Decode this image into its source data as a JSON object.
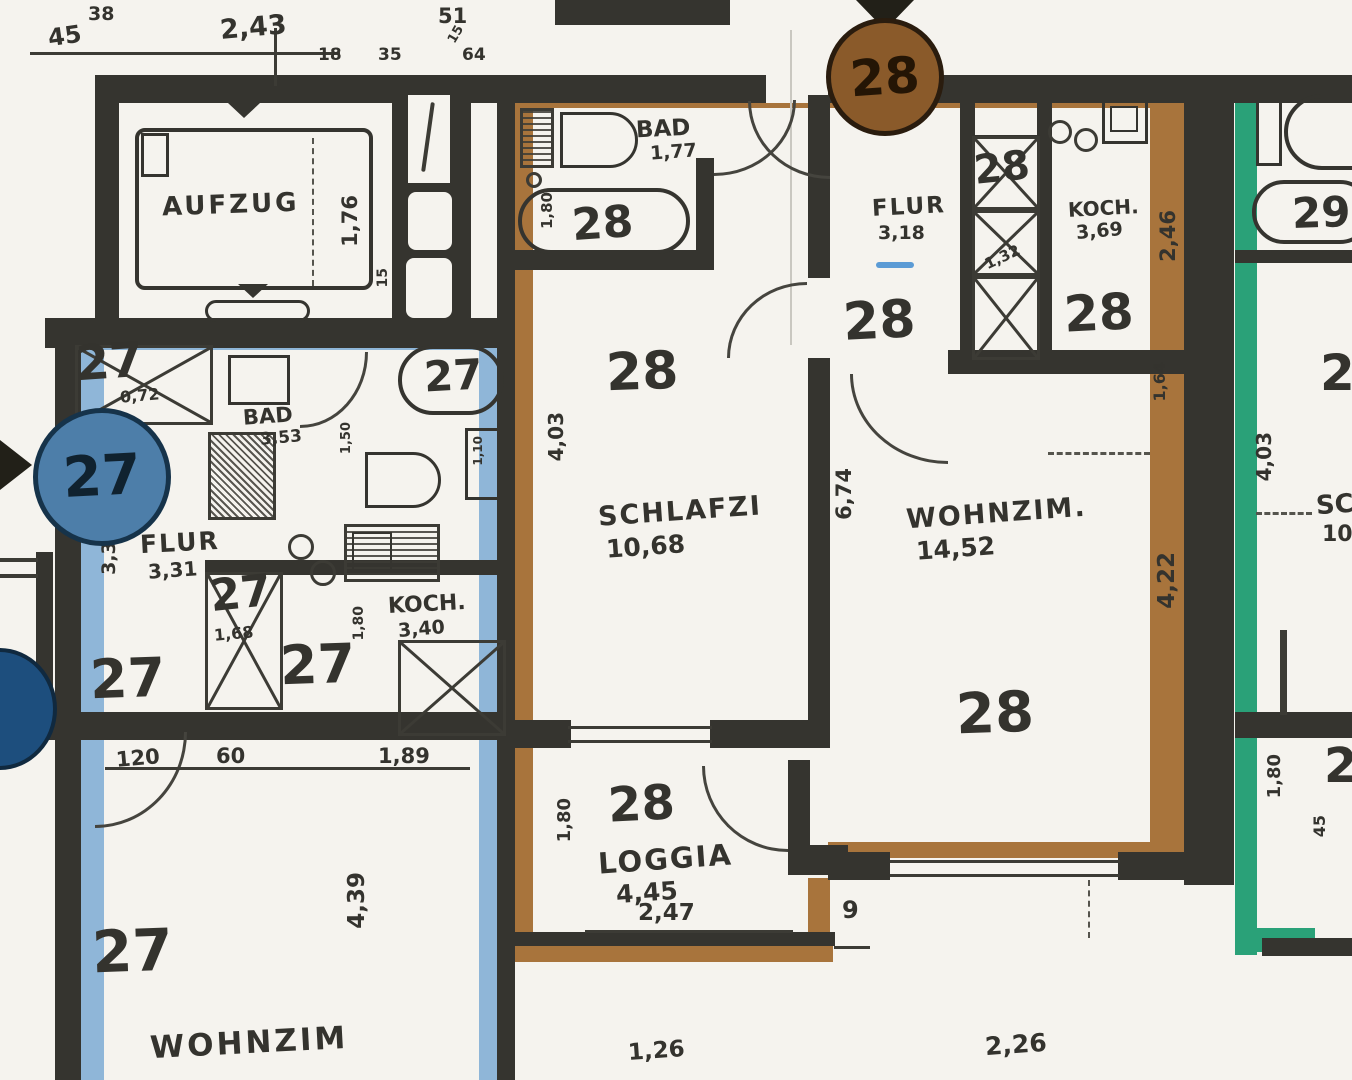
{
  "document": {
    "type": "scanned-floor-plan",
    "language": "de"
  },
  "colors": {
    "paper": "#f5f3ee",
    "wall": "#35342f",
    "ink": "#2d2c28",
    "unit27_band": "#8fb6d8",
    "unit27_marker": "#4d7ea9",
    "unit27_marker_partial": "#1d4e7d",
    "unit28_band": "#a8743c",
    "unit28_marker": "#8a5a2a",
    "unit29_band": "#2aa178",
    "flur28_dash": "#5b9bd5"
  },
  "markers": {
    "c27": "27",
    "c28": "28"
  },
  "top": {
    "d45": "45",
    "d38": "38",
    "d243": "2,43",
    "d51": "51",
    "d18": "18",
    "d35": "35",
    "d15": "15",
    "d64": "64"
  },
  "aufzug": {
    "name": "AUFZUG",
    "h176": "1,76",
    "d15": "15"
  },
  "u27": {
    "n_closet": "27",
    "closet_area": "0,72",
    "bad": "BAD",
    "bad_area": "3,53",
    "d150": "1,50",
    "d110": "1,10",
    "tub_n": "27",
    "flur": "FLUR",
    "flur_area": "3,31",
    "d336": "3,36",
    "n_flur": "27",
    "n_closet2": "27",
    "d168": "1,68",
    "koch": "KOCH.",
    "koch_area": "3,40",
    "d180": "1,80",
    "n_koch": "27",
    "d120": "120",
    "d60": "60",
    "d189": "1,89",
    "d439": "4,39",
    "n_wohn": "27",
    "wohnzim": "WOHNZIM"
  },
  "u28": {
    "bad": "BAD",
    "bad_area": "1,77",
    "n_tub": "28",
    "d180": "1,80",
    "flur": "FLUR",
    "flur_area": "3,18",
    "n_flur": "28",
    "n_closet": "28",
    "d132": "1,32",
    "koch": "KOCH.",
    "koch_area": "3,69",
    "d246": "2,46",
    "n_koch": "28",
    "n_schlafzi": "28",
    "schlafzi": "SCHLAFZI",
    "schlafzi_area": "10,68",
    "d403": "4,03",
    "d674": "6,74",
    "wohnzim": "WOHNZIM.",
    "wohnzim_area": "14,52",
    "d164": "1,64",
    "d422": "4,22",
    "n_wohn": "28",
    "n_loggia": "28",
    "loggia": "LOGGIA",
    "loggia_area": "4,45",
    "d247": "2,47",
    "d180b": "1,80",
    "d9": "9",
    "d126": "1,26",
    "d226": "2,26"
  },
  "u29": {
    "n": "29",
    "d403": "4,03",
    "schlafzi": "SC",
    "schlafzi_area": "10,",
    "p_top": "2",
    "p_bottom": "2",
    "d180": "1,80",
    "d45": "45"
  }
}
